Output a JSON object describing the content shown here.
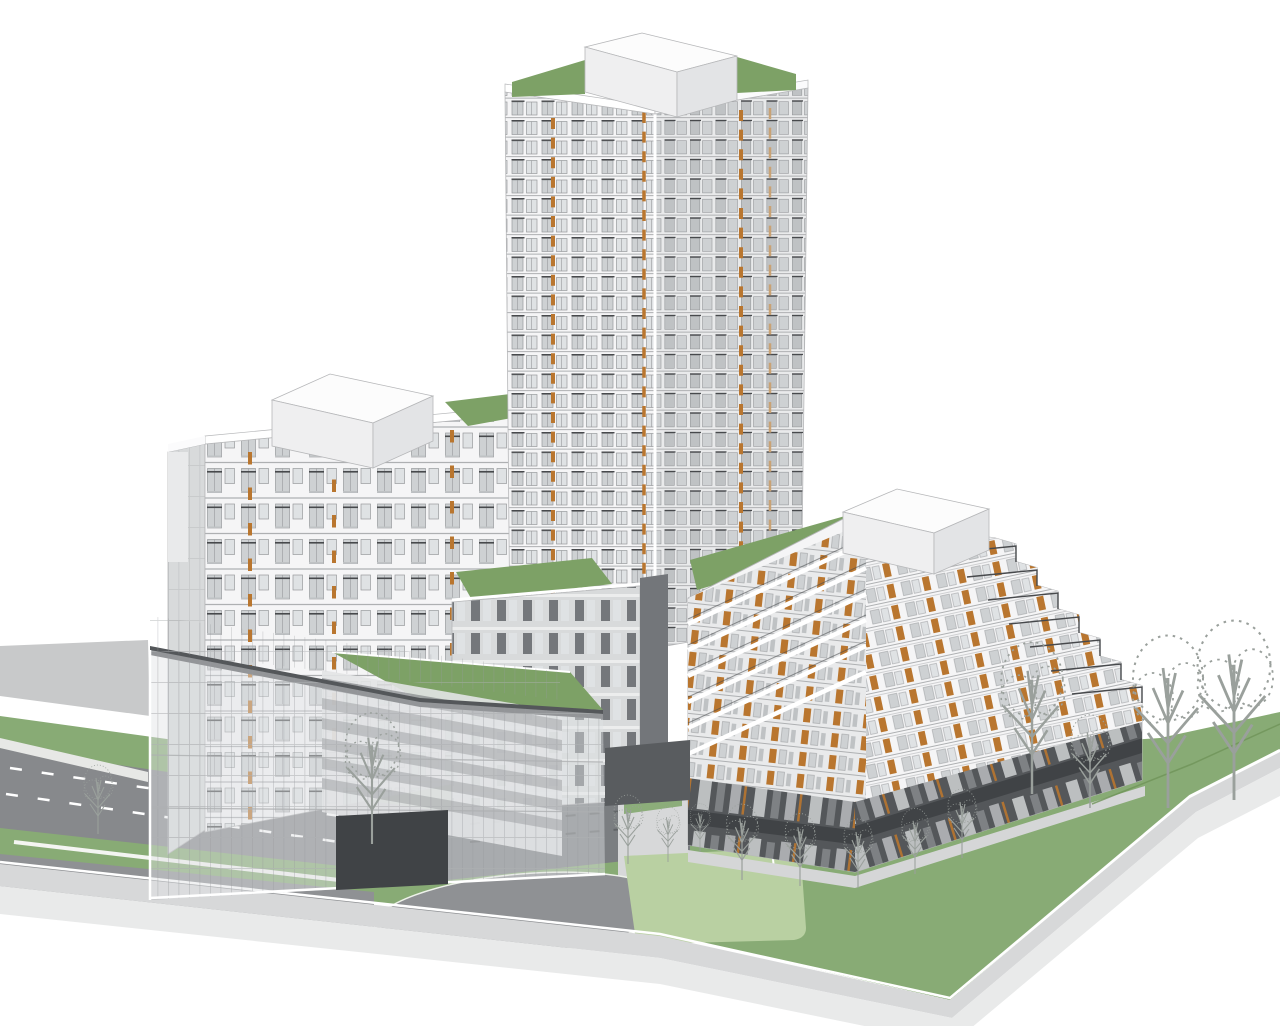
{
  "meta": {
    "description": "3D architectural massing rendering of a multi-building residential development with green roofs, viewed from the southwest",
    "render_style": "white-line architectural model"
  },
  "palette": {
    "white": "#ffffff",
    "facadeWhite": "#f5f5f6",
    "facadeShade": "#e9eaeb",
    "facadeDark": "#d8dadb",
    "roofWhite": "#fbfbfc",
    "penthouseTop": "#fcfcfc",
    "penthouseSide": "#efeff0",
    "penthouseDark": "#e3e4e6",
    "glassLight": "#dfe2e4",
    "glassMid": "#ced1d3",
    "glassDeep": "#bfc2c4",
    "mullion": "#97999c",
    "frameGray": "#aeb0b2",
    "charcoal": "#54575a",
    "charcoalDeep": "#404346",
    "bridgeGray": "#595c5f",
    "windowDark": "#63666a",
    "innerBg": "#e3e4e6",
    "roofGreen": "#7da166",
    "lawnGreen": "#88ab75",
    "lawnLight": "#b9d0a2",
    "greenEdge": "#6f9459",
    "roadDark": "#87898c",
    "roadMid": "#8f9194",
    "roadLight": "#c8c9ca",
    "sidewalk": "#d7d8d9",
    "plinthFace": "#e9eaea",
    "pathLight": "#e7e8e6",
    "orange": "#b9762f",
    "orangeTan": "#c9a274",
    "rail": "#47494c",
    "treeLine": "#9aa09c",
    "outline": "#b6b7b9"
  },
  "scene": {
    "view": "aerial-southwest-axonometric",
    "buildings": {
      "central_tower": {
        "floors_visible": 26,
        "roof": "green-roof",
        "mechanical_penthouse": true,
        "accents": "orange-vertical-window-strips"
      },
      "west_midrise": {
        "floors_visible": 10,
        "roof": "green-roof",
        "mechanical_penthouse": true,
        "accents": "orange-vertical-window-strips"
      },
      "east_terraced_midrise": {
        "terrace_steps": 7,
        "mechanical_penthouse": true,
        "ground_floor": "dark-retail-storefronts",
        "accents": "orange-door-panels",
        "balconies": "stepped-terraces-with-railings"
      },
      "glass_podium": {
        "curtain_wall": true,
        "green_roof_terrace": true,
        "vehicle_archway": true
      },
      "link_wing": {
        "green_roof": true
      }
    },
    "site": {
      "features": [
        "entry drive with oval turnaround loop",
        "play lawn (light green)",
        "street with dashed lane markings",
        "perimeter sidewalks on raised plinth",
        "bare street trees",
        "green verges and paths"
      ]
    }
  }
}
